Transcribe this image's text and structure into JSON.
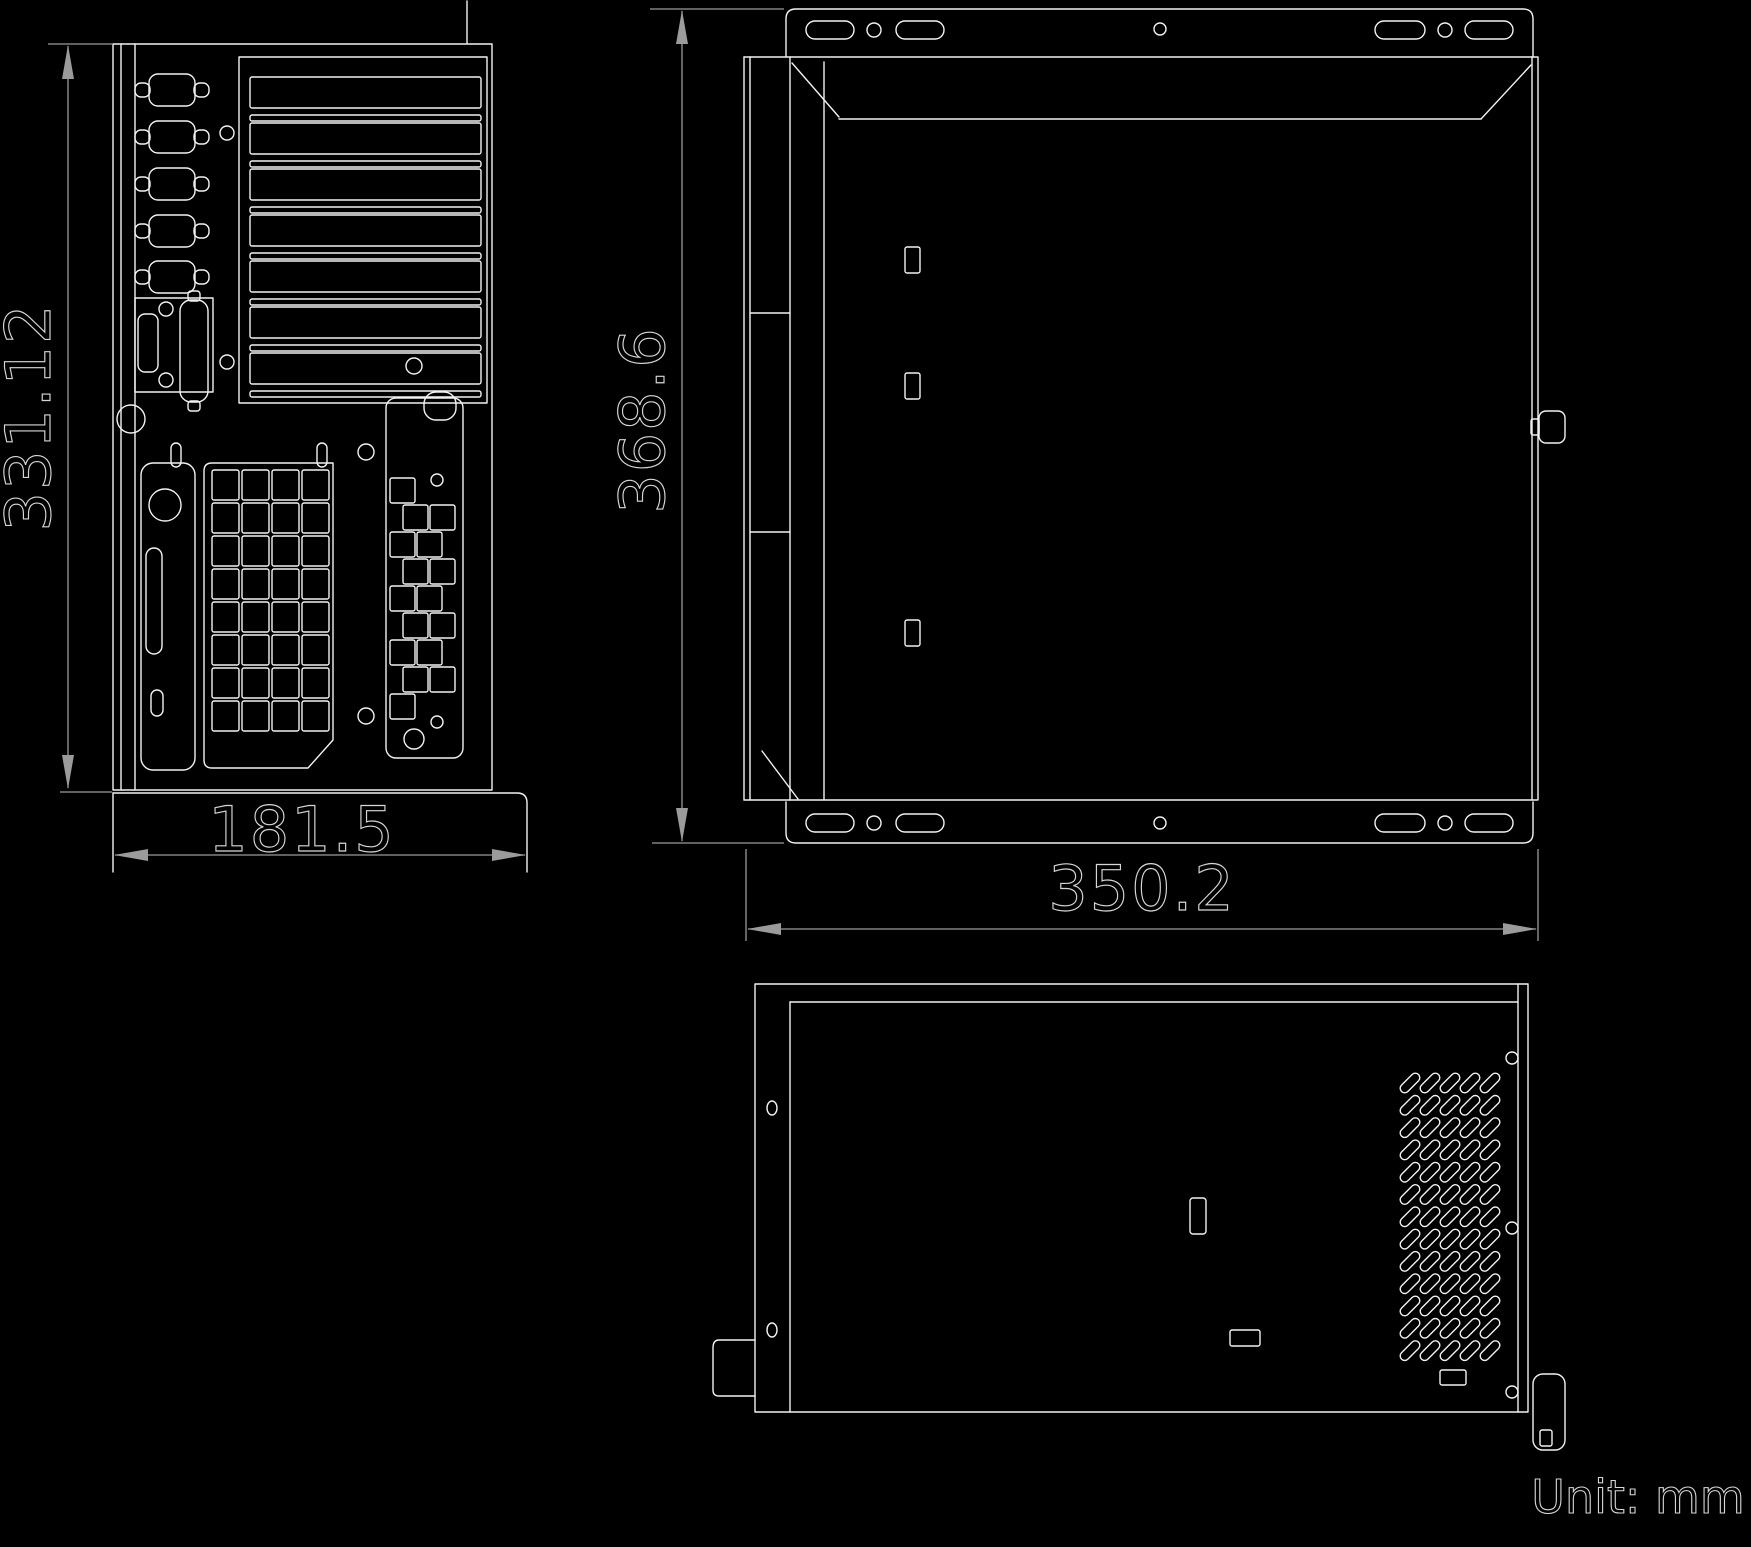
{
  "page": {
    "background": "#000000"
  },
  "colors": {
    "geometry_line": "#f2f2f2",
    "dimension_line": "#9b9b9b",
    "dimension_text_outline": "#d6d6d6"
  },
  "unit_note": "Unit: mm",
  "dimensions": {
    "rear_view_height_mm": "331.12",
    "rear_view_base_width_mm": "181.5",
    "side_view_height_mm": "368.6",
    "side_view_width_mm": "350.2"
  }
}
